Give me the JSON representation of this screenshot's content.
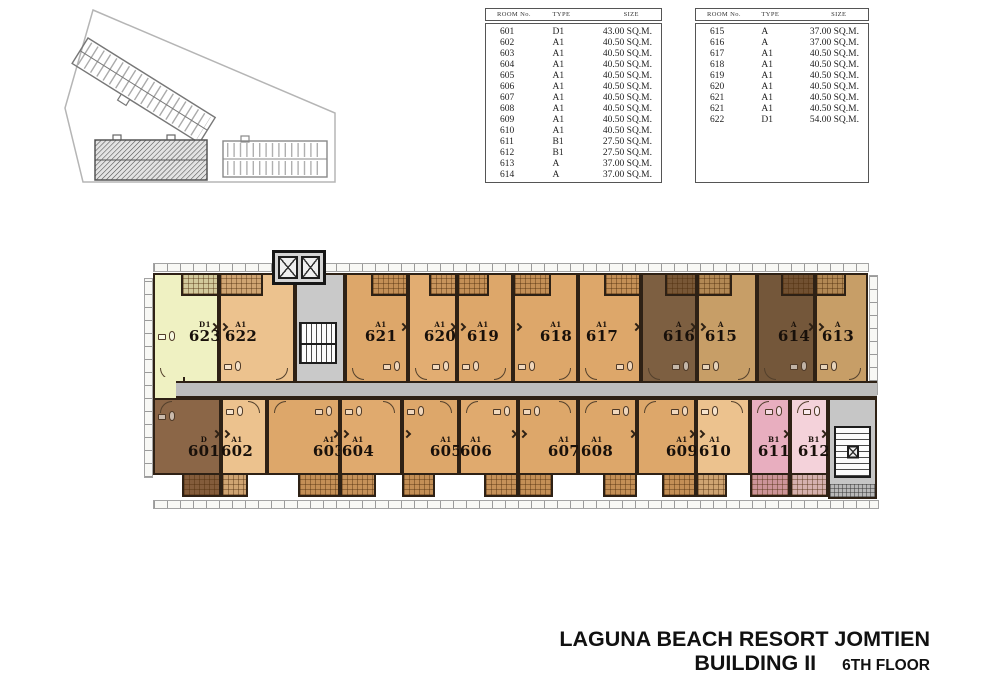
{
  "title_block": {
    "line1": "LAGUNA BEACH RESORT JOMTIEN",
    "line2": "BUILDING II",
    "line3": "6TH FLOOR"
  },
  "tables": [
    {
      "headers": [
        "ROOM No.",
        "TYPE",
        "SIZE"
      ],
      "rows": [
        [
          "601",
          "D1",
          "43.00 SQ.M."
        ],
        [
          "602",
          "A1",
          "40.50 SQ.M."
        ],
        [
          "603",
          "A1",
          "40.50 SQ.M."
        ],
        [
          "604",
          "A1",
          "40.50 SQ.M."
        ],
        [
          "605",
          "A1",
          "40.50 SQ.M."
        ],
        [
          "606",
          "A1",
          "40.50 SQ.M."
        ],
        [
          "607",
          "A1",
          "40.50 SQ.M."
        ],
        [
          "608",
          "A1",
          "40.50 SQ.M."
        ],
        [
          "609",
          "A1",
          "40.50 SQ.M."
        ],
        [
          "610",
          "A1",
          "40.50 SQ.M."
        ],
        [
          "611",
          "B1",
          "27.50 SQ.M."
        ],
        [
          "612",
          "B1",
          "27.50 SQ.M."
        ],
        [
          "613",
          "A",
          "37.00 SQ.M."
        ],
        [
          "614",
          "A",
          "37.00 SQ.M."
        ]
      ]
    },
    {
      "headers": [
        "ROOM No.",
        "TYPE",
        "SIZE"
      ],
      "rows": [
        [
          "615",
          "A",
          "37.00 SQ.M."
        ],
        [
          "616",
          "A",
          "37.00 SQ.M."
        ],
        [
          "617",
          "A1",
          "40.50 SQ.M."
        ],
        [
          "618",
          "A1",
          "40.50 SQ.M."
        ],
        [
          "619",
          "A1",
          "40.50 SQ.M."
        ],
        [
          "620",
          "A1",
          "40.50 SQ.M."
        ],
        [
          "621",
          "A1",
          "40.50 SQ.M."
        ],
        [
          "621",
          "A1",
          "40.50 SQ.M."
        ],
        [
          "622",
          "D1",
          "54.00 SQ.M."
        ]
      ]
    }
  ],
  "floor_plan": {
    "colors": {
      "corridor": "#bdbdbd",
      "core": "#c9c9c9",
      "wall": "#2e2115",
      "room_623": "#eff1c2",
      "room_a1_medium": "#dda76a",
      "room_a1_light": "#ecc28e",
      "room_a_tan": "#c79e67",
      "room_a_dark": "#7d5f41",
      "room_601_dark": "#8b6647",
      "room_611_pink": "#e8aebf",
      "room_612_pink": "#f4d2da"
    },
    "rows": {
      "top": {
        "y": 30,
        "h": 110,
        "label_y": 46
      },
      "bottom": {
        "y": 155,
        "h": 77,
        "label_y": 36
      }
    },
    "rooms": [
      {
        "number": "623",
        "type": "D1",
        "row": "top",
        "x": 5,
        "w": 66,
        "color": "#eff1c2",
        "balcony": "right",
        "label_x": 55
      },
      {
        "number": "622",
        "type": "A1",
        "row": "top",
        "x": 71,
        "w": 76,
        "color": "#ecc28e",
        "balcony": "left",
        "label_x": 91
      },
      {
        "number": "621",
        "type": "A1",
        "row": "top",
        "x": 197,
        "w": 63,
        "color": "#dda76a",
        "balcony": "right",
        "label_x": 231
      },
      {
        "number": "620",
        "type": "A1",
        "row": "top",
        "x": 260,
        "w": 49,
        "color": "#e2ad72",
        "balcony": "right",
        "label_x": 290
      },
      {
        "number": "619",
        "type": "A1",
        "row": "top",
        "x": 309,
        "w": 56,
        "color": "#dda76a",
        "balcony": "left",
        "label_x": 333
      },
      {
        "number": "618",
        "type": "A1",
        "row": "top",
        "x": 365,
        "w": 65,
        "color": "#dda76a",
        "balcony": "left",
        "label_x": 406
      },
      {
        "number": "617",
        "type": "A1",
        "row": "top",
        "x": 430,
        "w": 63,
        "color": "#dda76a",
        "balcony": "right",
        "label_x": 452
      },
      {
        "number": "616",
        "type": "A",
        "row": "top",
        "x": 493,
        "w": 56,
        "color": "#7d5f41",
        "balcony": "right",
        "label_x": 529
      },
      {
        "number": "615",
        "type": "A",
        "row": "top",
        "x": 549,
        "w": 60,
        "color": "#c79e67",
        "balcony": "left",
        "label_x": 571
      },
      {
        "number": "614",
        "type": "A",
        "row": "top",
        "x": 609,
        "w": 58,
        "color": "#74573a",
        "balcony": "right",
        "label_x": 644
      },
      {
        "number": "613",
        "type": "A",
        "row": "top",
        "x": 667,
        "w": 53,
        "color": "#c79e67",
        "balcony": "left",
        "label_x": 688
      },
      {
        "number": "601",
        "type": "D",
        "row": "bottom",
        "x": 5,
        "w": 68,
        "color": "#8b6647",
        "balcony": "right",
        "label_x": 54
      },
      {
        "number": "602",
        "type": "A1",
        "row": "bottom",
        "x": 73,
        "w": 46,
        "color": "#ecc28e",
        "balcony": "left",
        "label_x": 87
      },
      {
        "number": "603",
        "type": "A1",
        "row": "bottom",
        "x": 119,
        "w": 73,
        "color": "#dda76a",
        "balcony": "right",
        "label_x": 179
      },
      {
        "number": "604",
        "type": "A1",
        "row": "bottom",
        "x": 192,
        "w": 62,
        "color": "#e0aa6e",
        "balcony": "left",
        "label_x": 208
      },
      {
        "number": "605",
        "type": "A1",
        "row": "bottom",
        "x": 254,
        "w": 57,
        "color": "#dda76a",
        "balcony": "left",
        "label_x": 296
      },
      {
        "number": "606",
        "type": "A1",
        "row": "bottom",
        "x": 311,
        "w": 59,
        "color": "#e0aa6e",
        "balcony": "right",
        "label_x": 326
      },
      {
        "number": "607",
        "type": "A1",
        "row": "bottom",
        "x": 370,
        "w": 60,
        "color": "#dda76a",
        "balcony": "left",
        "label_x": 414
      },
      {
        "number": "608",
        "type": "A1",
        "row": "bottom",
        "x": 430,
        "w": 59,
        "color": "#dda76a",
        "balcony": "right",
        "label_x": 447
      },
      {
        "number": "609",
        "type": "A1",
        "row": "bottom",
        "x": 489,
        "w": 59,
        "color": "#dda76a",
        "balcony": "right",
        "label_x": 532
      },
      {
        "number": "610",
        "type": "A1",
        "row": "bottom",
        "x": 548,
        "w": 54,
        "color": "#ecc28e",
        "balcony": "left",
        "label_x": 565
      },
      {
        "number": "611",
        "type": "B1",
        "row": "bottom",
        "x": 602,
        "w": 40,
        "color": "#e8aebf",
        "balcony": "full",
        "label_x": 624
      },
      {
        "number": "612",
        "type": "B1",
        "row": "bottom",
        "x": 642,
        "w": 38,
        "color": "#f4d2da",
        "balcony": "full",
        "label_x": 664
      }
    ]
  }
}
